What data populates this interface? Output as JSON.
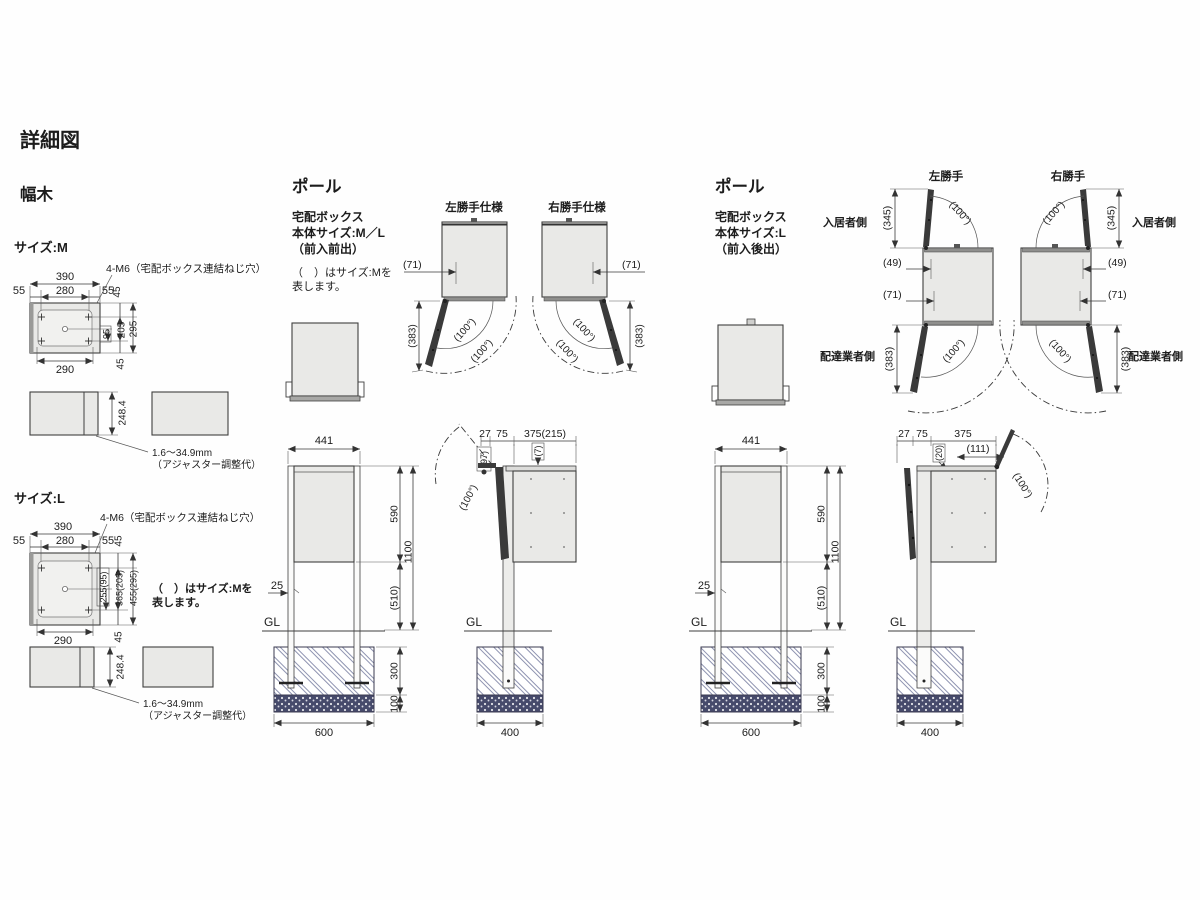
{
  "colors": {
    "box_fill": "#e9e9e7",
    "door_fill": "#3a3a3a",
    "line": "#3f3f3f",
    "hatch_line": "#8e93b0",
    "gravel_fill": "#464a6b",
    "text": "#1c1c1c"
  },
  "title": "詳細図",
  "habaki": {
    "heading": "幅木",
    "m": {
      "size_label": "サイズ:M",
      "screw_note": "4-M6（宅配ボックス連結ねじ穴）",
      "w_total": "390",
      "w_left": "55",
      "w_center": "280",
      "w_right": "55",
      "v_top": "45",
      "v_95": "95",
      "v_205": "205",
      "v_295": "295",
      "v_bottom": "45",
      "w_bottom": "290",
      "side_height": "248.4",
      "adjuster1": "1.6〜34.9mm",
      "adjuster2": "（アジャスター調整代）"
    },
    "l": {
      "size_label": "サイズ:L",
      "screw_note": "4-M6（宅配ボックス連結ねじ穴）",
      "w_total": "390",
      "w_left": "55",
      "w_center": "280",
      "w_right": "55",
      "v_top": "45",
      "v_255": "255(95)",
      "v_365": "365(205)",
      "v_455": "455(295)",
      "v_bottom": "45",
      "w_bottom": "290",
      "note1": "（　）はサイズ:Mを",
      "note2": "表します。",
      "side_height": "248.4",
      "adjuster1": "1.6〜34.9mm",
      "adjuster2": "（アジャスター調整代）"
    }
  },
  "pole_front": {
    "heading": "ポール",
    "product": "宅配ボックス",
    "body_size": "本体サイズ:M／L",
    "loading": "（前入前出）",
    "note1": "（　）はサイズ:Mを",
    "note2": "表します。",
    "left_label": "左勝手仕様",
    "right_label": "右勝手仕様",
    "d71": "(71)",
    "d383": "(383)",
    "angle": "(100°)",
    "front": {
      "w441": "441",
      "h590": "590",
      "h1100": "1100",
      "p25": "25",
      "h510": "(510)",
      "gl": "GL",
      "f300": "300",
      "f100": "100",
      "f600": "600"
    },
    "side": {
      "d27": "27",
      "d75": "75",
      "d375": "375(215)",
      "d97": "(97)",
      "d7": "(7)",
      "angle": "(100°)",
      "gl": "GL",
      "f400": "400"
    }
  },
  "pole_rear": {
    "heading": "ポール",
    "product": "宅配ボックス",
    "body_size": "本体サイズ:L",
    "loading": "（前入後出）",
    "left_label": "左勝手",
    "right_label": "右勝手",
    "resident": "入居者側",
    "courier": "配達業者側",
    "d345": "(345)",
    "d49": "(49)",
    "d71": "(71)",
    "d383": "(383)",
    "angle": "(100°)",
    "front": {
      "w441": "441",
      "h590": "590",
      "h1100": "1100",
      "p25": "25",
      "h510": "(510)",
      "gl": "GL",
      "f300": "300",
      "f100": "100",
      "f600": "600"
    },
    "side": {
      "d27": "27",
      "d75": "75",
      "d375": "375",
      "d20": "(20)",
      "d111": "(111)",
      "angle": "(100°)",
      "gl": "GL",
      "f400": "400"
    }
  }
}
